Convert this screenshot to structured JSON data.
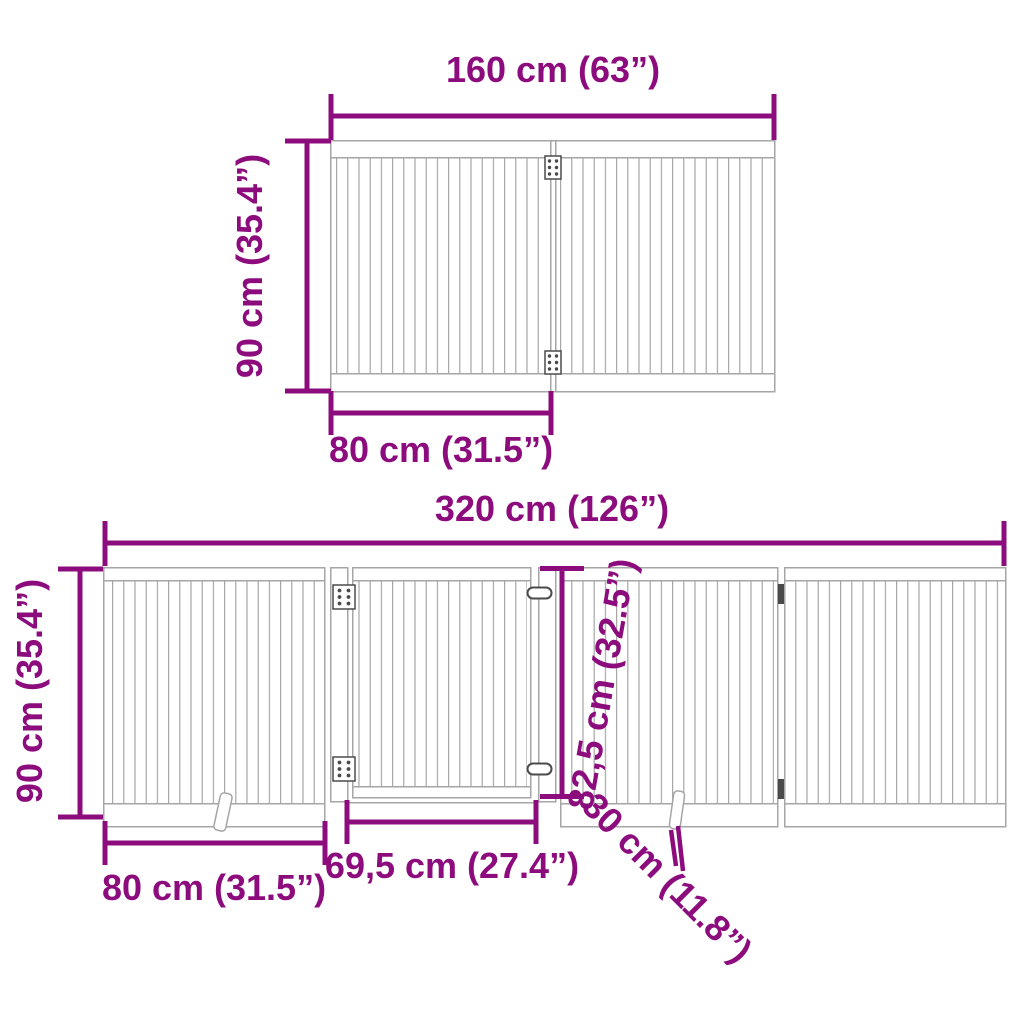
{
  "figure": {
    "type": "product-dimension-diagram",
    "subject": "foldable slatted pet gate panels with door and support feet"
  },
  "colors": {
    "dimension": "#8D0C7D",
    "outline": "#A6A6A6",
    "hardware": "#4A4A4A",
    "background": "#FFFFFF"
  },
  "top_diagram": {
    "name": "two-panel gate front view",
    "overall_width_label": "160 cm (63”)",
    "overall_height_label": "90 cm (35.4”)",
    "panel_width_label": "80 cm (31.5”)"
  },
  "bottom_diagram": {
    "name": "four-panel gate with door front view",
    "overall_width_label": "320 cm (126”)",
    "overall_height_label": "90 cm (35.4”)",
    "panel_width_label": "80 cm (31.5”)",
    "door_width_label": "69,5 cm (27.4”)",
    "door_height_label": "82,5 cm (32.5”)",
    "foot_depth_label": "30 cm (11.8”)"
  }
}
